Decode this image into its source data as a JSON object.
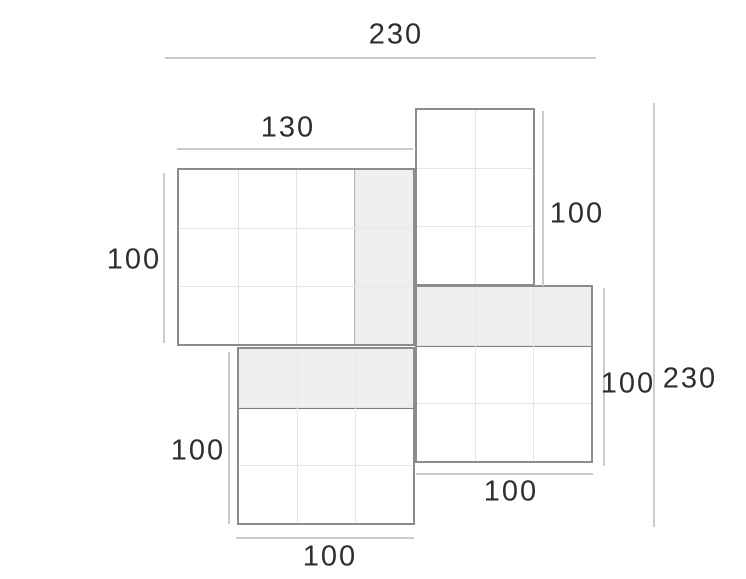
{
  "page": {
    "width": 746,
    "height": 579,
    "background": "#ffffff"
  },
  "diagram": {
    "type": "dimensioned-panel-layout-drawing",
    "colors": {
      "panel_border": "#8c8c8c",
      "grid_line": "#e5e5e5",
      "shaded_fill": "#efefef",
      "shade_edge_dark": "#7d7d7d",
      "shade_edge_light": "#b7b7b7",
      "dimension_line": "#cbcbcb",
      "label_text": "#2e2e2e"
    },
    "panels": [
      {
        "id": "left-panel",
        "x": 177,
        "y": 168,
        "w": 238,
        "h": 178,
        "cols": 4,
        "rows": 3,
        "shade": {
          "side": "right",
          "size": 59
        }
      },
      {
        "id": "top-right-panel",
        "x": 415,
        "y": 108,
        "w": 120,
        "h": 178,
        "cols": 2,
        "rows": 3,
        "shade": null
      },
      {
        "id": "right-panel",
        "x": 415,
        "y": 285,
        "w": 178,
        "h": 178,
        "cols": 3,
        "rows": 3,
        "shade": {
          "side": "top",
          "size": 60
        }
      },
      {
        "id": "bottom-left-panel",
        "x": 237,
        "y": 347,
        "w": 178,
        "h": 178,
        "cols": 3,
        "rows": 3,
        "shade": {
          "side": "top",
          "size": 60
        }
      }
    ],
    "dimensions": [
      {
        "id": "dim-total-width",
        "label": "230",
        "orientation": "horizontal",
        "x1": 165,
        "x2": 596,
        "y": 57,
        "label_x": 396,
        "label_y": 35
      },
      {
        "id": "dim-left-panel-width",
        "label": "130",
        "orientation": "horizontal",
        "x1": 177,
        "x2": 413,
        "y": 148,
        "label_x": 288,
        "label_y": 128
      },
      {
        "id": "dim-left-panel-height",
        "label": "100",
        "orientation": "vertical",
        "x": 163,
        "y1": 173,
        "y2": 343,
        "label_x": 134,
        "label_y": 260
      },
      {
        "id": "dim-top-right-height",
        "label": "100",
        "orientation": "vertical",
        "x": 542,
        "y1": 111,
        "y2": 286,
        "label_x": 577,
        "label_y": 214
      },
      {
        "id": "dim-right-panel-height",
        "label": "100",
        "orientation": "vertical",
        "x": 603,
        "y1": 288,
        "y2": 466,
        "label_x": 628,
        "label_y": 384
      },
      {
        "id": "dim-total-height",
        "label": "230",
        "orientation": "vertical",
        "x": 653,
        "y1": 103,
        "y2": 527,
        "label_x": 690,
        "label_y": 379
      },
      {
        "id": "dim-bottom-left-height",
        "label": "100",
        "orientation": "vertical",
        "x": 228,
        "y1": 352,
        "y2": 524,
        "label_x": 198,
        "label_y": 451
      },
      {
        "id": "dim-bottom-left-width",
        "label": "100",
        "orientation": "horizontal",
        "x1": 236,
        "x2": 414,
        "y": 537,
        "label_x": 330,
        "label_y": 557
      },
      {
        "id": "dim-right-panel-width",
        "label": "100",
        "orientation": "horizontal",
        "x1": 416,
        "x2": 593,
        "y": 473,
        "label_x": 511,
        "label_y": 492
      }
    ]
  }
}
